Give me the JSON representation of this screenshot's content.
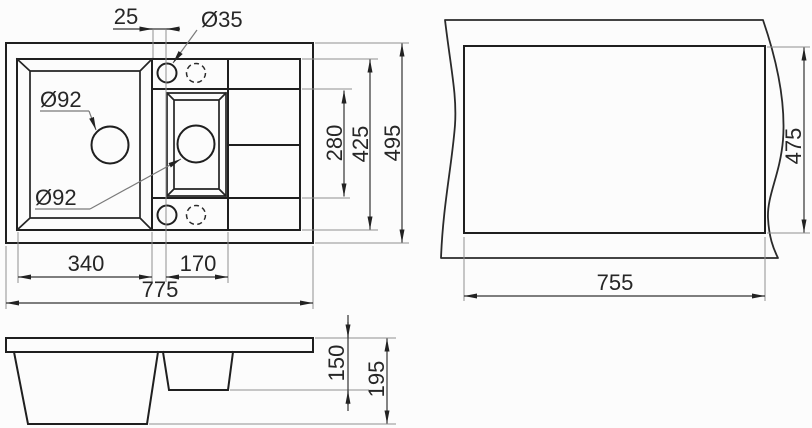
{
  "drawing": {
    "type": "sink-dimension-drawing",
    "line_color": "#1f1f1f",
    "extension_line_color": "#8f8f8f",
    "background": "#fcfcfc",
    "views": {
      "plan": {
        "dims": {
          "faucet_offset": "25",
          "faucet_dia": "Ø35",
          "main_drain_dia": "Ø92",
          "small_drain_dia": "Ø92",
          "small_bowl_length": "280",
          "inner_width": "425",
          "overall_width": "495",
          "main_bowl_length": "340",
          "small_bowl_span": "170",
          "overall_length": "775"
        }
      },
      "cutout": {
        "dims": {
          "cutout_length": "755",
          "cutout_width": "475"
        }
      },
      "side": {
        "dims": {
          "small_bowl_depth": "150",
          "overall_depth": "195"
        }
      }
    }
  }
}
